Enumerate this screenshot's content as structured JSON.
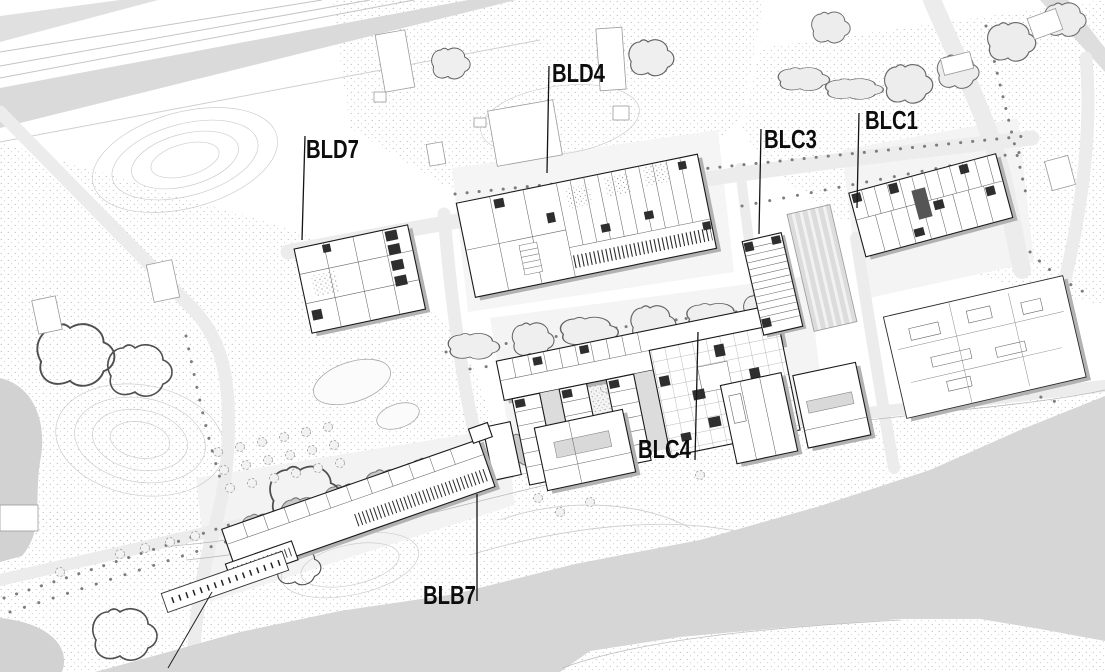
{
  "plan": {
    "labels": [
      {
        "id": "bld7",
        "text": "BLD7"
      },
      {
        "id": "bld4",
        "text": "BLD4"
      },
      {
        "id": "blc3",
        "text": "BLC3"
      },
      {
        "id": "blc1",
        "text": "BLC1"
      },
      {
        "id": "blc4",
        "text": "BLC4"
      },
      {
        "id": "blb7",
        "text": "BLB7"
      }
    ],
    "colors": {
      "paper": "#ffffff",
      "ink": "#141414",
      "road": "#ececec",
      "rail_band": "#dadada",
      "water": "#d6d6d6",
      "building_shadow": "#b2b2b2",
      "stipple": "#a9a9a9"
    }
  }
}
